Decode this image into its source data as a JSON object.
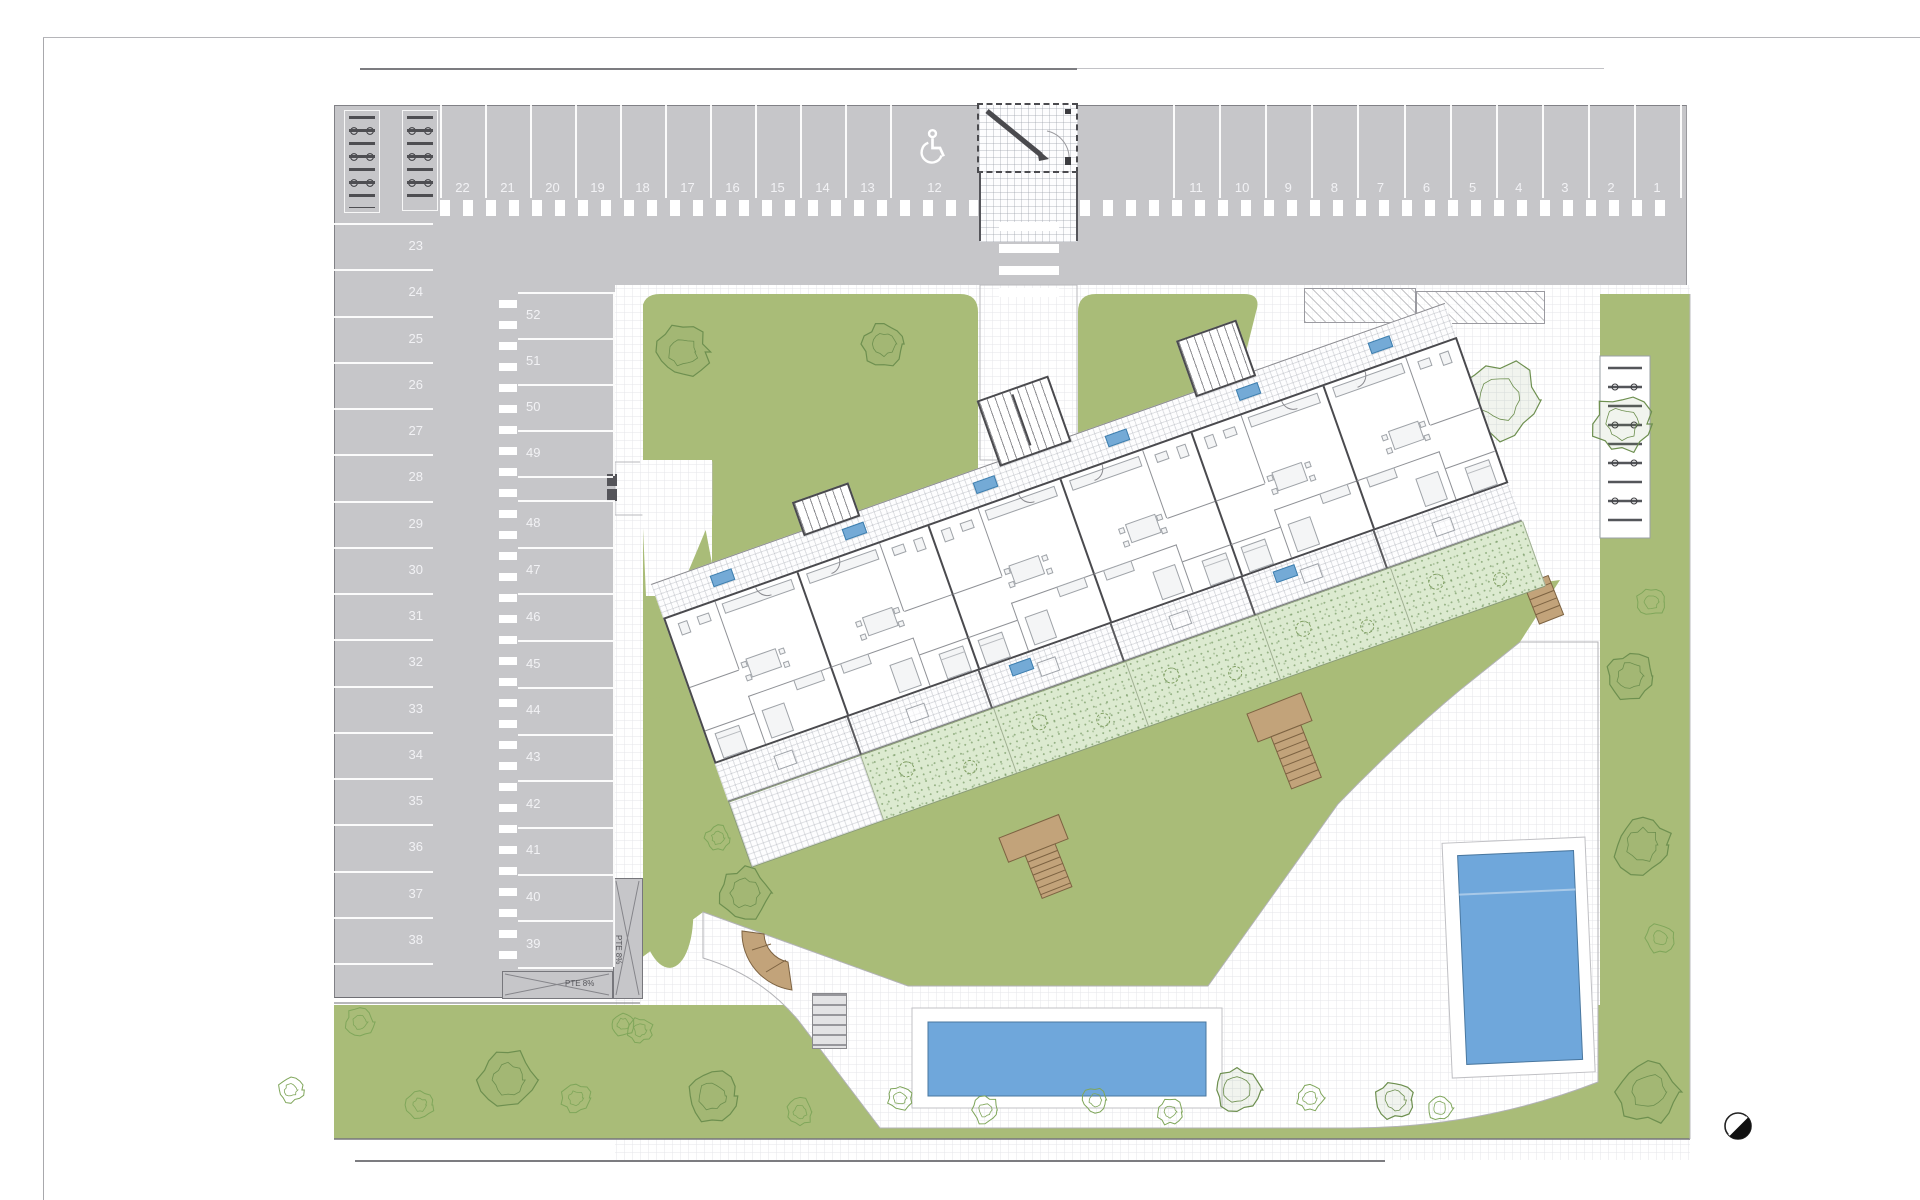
{
  "document": {
    "type": "residential site plan drawing",
    "background": "#ffffff"
  },
  "colors": {
    "asphalt": "#c6c6c9",
    "marking_white": "#ffffff",
    "stall_number": "#f2f2f5",
    "grass": "#a9bc78",
    "private_garden": "#dcead0",
    "paving": "#fdfdfe",
    "pool_water": "#6fa7db",
    "pool_deck": "#ffffff",
    "wood_stair": "#c2a37a",
    "building_wall": "#4a4a4e",
    "unit_tag_blue": "#74aad6",
    "tree_stroke": "#6d8f4f",
    "bush_stroke": "#7fa65a"
  },
  "parking": {
    "top_row_left_labels": [
      "22",
      "21",
      "20",
      "19",
      "18",
      "17",
      "16",
      "15",
      "14",
      "13"
    ],
    "handicap_label": "12",
    "top_row_right_labels": [
      "11",
      "10",
      "9",
      "8",
      "7",
      "6",
      "5",
      "4",
      "3",
      "2",
      "1"
    ],
    "left_column_labels": [
      "23",
      "24",
      "25",
      "26",
      "27",
      "28",
      "29",
      "30",
      "31",
      "32",
      "33",
      "34",
      "35",
      "36",
      "37",
      "38"
    ],
    "middle_column_upper_labels": [
      "52",
      "51",
      "50",
      "49"
    ],
    "middle_column_lower_labels": [
      "48",
      "47",
      "46",
      "45",
      "44",
      "43",
      "42",
      "41",
      "40",
      "39"
    ],
    "total_spaces": 52
  },
  "ramps": {
    "vertical_label": "PTE 8%",
    "horizontal_label": "PTE 8%"
  },
  "site": {
    "building_units": 6,
    "pools": 2,
    "bike_racks": 3,
    "north_arrow": "compass"
  },
  "landscape": {
    "trees": [
      {
        "x": 683,
        "y": 352,
        "r": 27
      },
      {
        "x": 884,
        "y": 344,
        "r": 22
      },
      {
        "x": 1500,
        "y": 400,
        "r": 40
      },
      {
        "x": 1622,
        "y": 424,
        "r": 30
      },
      {
        "x": 1630,
        "y": 676,
        "r": 24
      },
      {
        "x": 1643,
        "y": 845,
        "r": 30
      },
      {
        "x": 1648,
        "y": 1092,
        "r": 32
      },
      {
        "x": 745,
        "y": 893,
        "r": 27
      },
      {
        "x": 508,
        "y": 1080,
        "r": 30
      },
      {
        "x": 712,
        "y": 1096,
        "r": 26
      },
      {
        "x": 1237,
        "y": 1090,
        "r": 24
      },
      {
        "x": 1395,
        "y": 1100,
        "r": 20
      }
    ],
    "bushes": [
      {
        "x": 360,
        "y": 1022,
        "r": 15
      },
      {
        "x": 291,
        "y": 1090,
        "r": 13
      },
      {
        "x": 420,
        "y": 1105,
        "r": 14
      },
      {
        "x": 576,
        "y": 1098,
        "r": 15
      },
      {
        "x": 640,
        "y": 1030,
        "r": 13
      },
      {
        "x": 800,
        "y": 1112,
        "r": 14
      },
      {
        "x": 900,
        "y": 1098,
        "r": 13
      },
      {
        "x": 985,
        "y": 1110,
        "r": 14
      },
      {
        "x": 1095,
        "y": 1100,
        "r": 13
      },
      {
        "x": 1170,
        "y": 1112,
        "r": 13
      },
      {
        "x": 1310,
        "y": 1098,
        "r": 14
      },
      {
        "x": 1660,
        "y": 938,
        "r": 15
      },
      {
        "x": 1651,
        "y": 602,
        "r": 15
      },
      {
        "x": 623,
        "y": 1024,
        "r": 12
      },
      {
        "x": 1440,
        "y": 1108,
        "r": 13
      },
      {
        "x": 718,
        "y": 838,
        "r": 13
      }
    ]
  }
}
